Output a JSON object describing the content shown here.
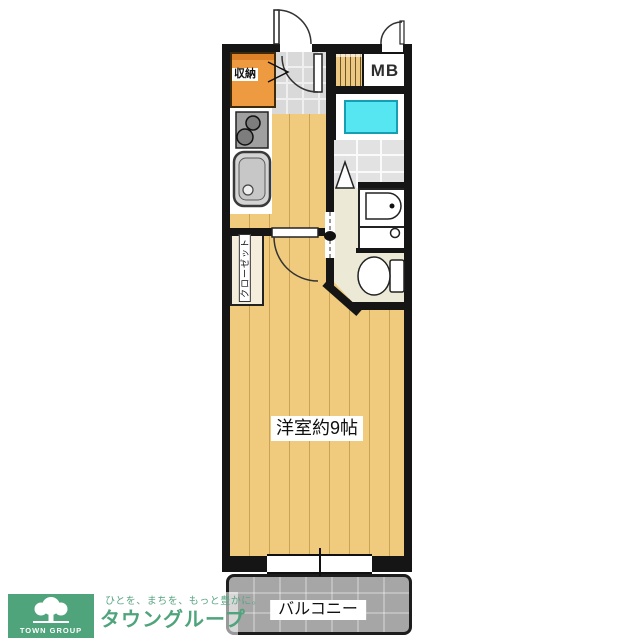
{
  "floorplan": {
    "rooms": {
      "storage_label": "収納",
      "meter_box_label": "MB",
      "closet_label": "クローゼット",
      "main_room_label": "洋室約9帖",
      "balcony_label": "バルコニー"
    },
    "fixtures": [
      "stove-icon",
      "sink-icon",
      "bathtub-icon",
      "bath-folding-door-icon",
      "washbasin-icon",
      "washing-machine-pan-icon",
      "toilet-icon",
      "entrance-door-arc-icon",
      "room-door-arc-icon",
      "folding-door-icon",
      "mb-door-arc-icon"
    ],
    "colors": {
      "wall": "#151515",
      "wood_floor": "#f0cb7e",
      "storage_orange": "#ee9a41",
      "bathtub_cyan": "#55e6f2",
      "entrance_tile_gray": "#d9d9d9",
      "washroom_cream": "#ece9d6",
      "balcony_gray": "#a6a6a6"
    }
  },
  "logo": {
    "brand_en": "TOWN GROUP",
    "tagline": "ひとを、まちを、もっと豊かに。",
    "brand_jp": "タウングループ",
    "green": "#4fa47c"
  }
}
